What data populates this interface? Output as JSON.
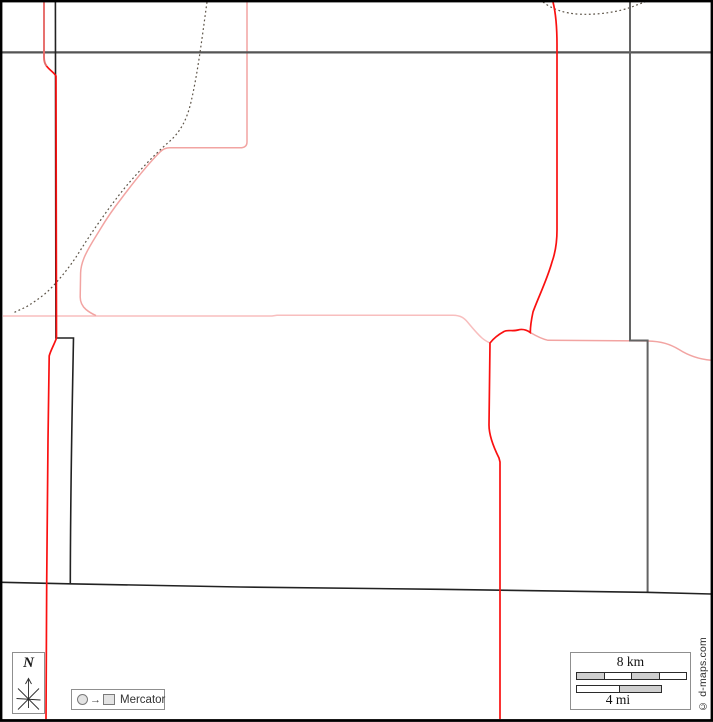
{
  "north": {
    "label": "N"
  },
  "projection": {
    "label": "Mercator",
    "arrow": "→"
  },
  "scalebar": {
    "km": "8 km",
    "mi": "4 mi"
  },
  "copyright": "© d-maps.com",
  "colors": {
    "frame": "#000000",
    "road-major-gray": "#545454",
    "boundary-gray": "#636363",
    "boundary-dark": "#222222",
    "road-red": "#fa1010",
    "road-red-light": "#e66a68",
    "road-pink": "#f2a4a2",
    "road-pink-light": "#f8bebe",
    "trail-dotted": "#5c5347",
    "legend-border": "#8f8f8f",
    "bar-gray": "#cfcfcf",
    "marker-fill": "#e3e3e3"
  }
}
